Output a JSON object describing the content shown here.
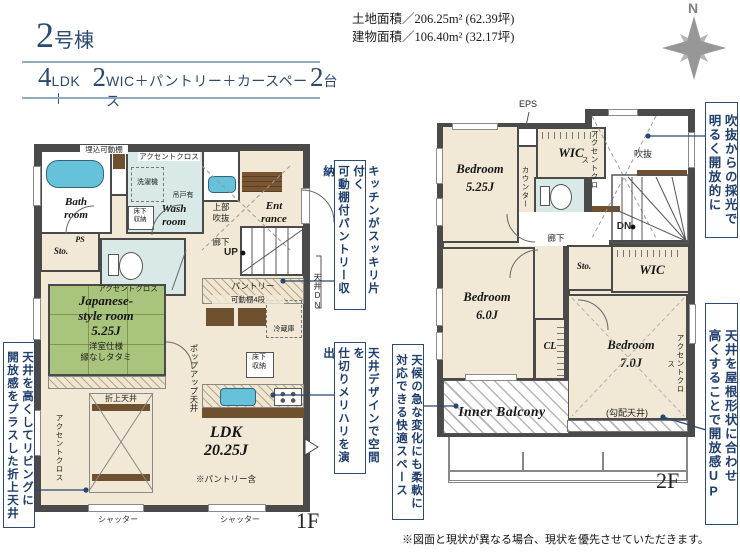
{
  "header": {
    "unit_no": "2",
    "unit_suffix": "号棟",
    "plan": {
      "n1": "4",
      "t1": "LDK＋",
      "n2": "2",
      "t2": "WIC＋パントリー＋カースペース",
      "n3": "2",
      "t3": "台"
    },
    "land_area": "土地面積／206.25m² (62.39坪)",
    "building_area": "建物面積／106.40m² (32.17坪)",
    "compass_n": "N"
  },
  "f1": {
    "floor_label": "1F",
    "bath": "Bath\nroom",
    "wash": "Wash\nroom",
    "entrance": "Ent\nrance",
    "ps": "PS",
    "sto": "Sto.",
    "washer": "洗濯機",
    "hang_cupboard": "吊戸有",
    "underfloor_a": "床下\n収納",
    "underfloor_b": "床下\n収納",
    "recessed_shelf": "埋込可動棚",
    "accent_top": "アクセントクロス",
    "void_upper": "上部\n吹抜",
    "hall": "廊下",
    "up": "UP",
    "jp_accent": "アクセントクロス",
    "jp_name": "Japanese-\nstyle room",
    "jp_size": "5.25J",
    "jp_note": "洋室仕様\n縁なしタタミ",
    "pantry": "パントリー",
    "shelf4": "可動棚4段",
    "fridge": "冷蔵庫",
    "ceiling_dn": "天井DN",
    "popup_ceiling": "ポップアップ天井",
    "coffered": "折上天井",
    "ldk_accent": "アクセントクロス",
    "ldk_name": "LDK\n20.25J",
    "ldk_note": "※パントリー含",
    "shutter_a": "シャッター",
    "shutter_b": "シャッター"
  },
  "f2": {
    "floor_label": "2F",
    "eps": "EPS",
    "wic_a": "WIC",
    "wic_b": "WIC",
    "sto": "Sto.",
    "cl": "CL",
    "void": "吹抜",
    "void_accent": "アクセントクロス",
    "counter": "カウンター",
    "dn": "DN",
    "hall": "廊下",
    "bed1_name": "Bedroom",
    "bed1_size": "5.25J",
    "bed2_name": "Bedroom",
    "bed2_size": "6.0J",
    "bed3_name": "Bedroom",
    "bed3_size": "7.0J",
    "sloped": "(勾配天井)",
    "bed3_accent": "アクセントクロス",
    "balcony": "Inner Balcony"
  },
  "annotations": {
    "left": "天井を高くしてリビングに\n開放感をプラスした折上天井",
    "mid_top": "キッチンがスッキリ片付く\n可動棚付パントリー収納",
    "mid_bottom": "天井デザインで空間を\n仕切りメリハリを演出",
    "mid_balcony": "天候の急な変化にも柔軟に\n対応できる快適スペース",
    "right_top": "吹抜からの採光で\n明るく開放的に",
    "right_bottom": "天井を屋根形状に合わせ\n高くすることで開放感UP"
  },
  "footer": {
    "disclaimer": "※図面と現状が異なる場合、現状を優先させていただきます。"
  }
}
